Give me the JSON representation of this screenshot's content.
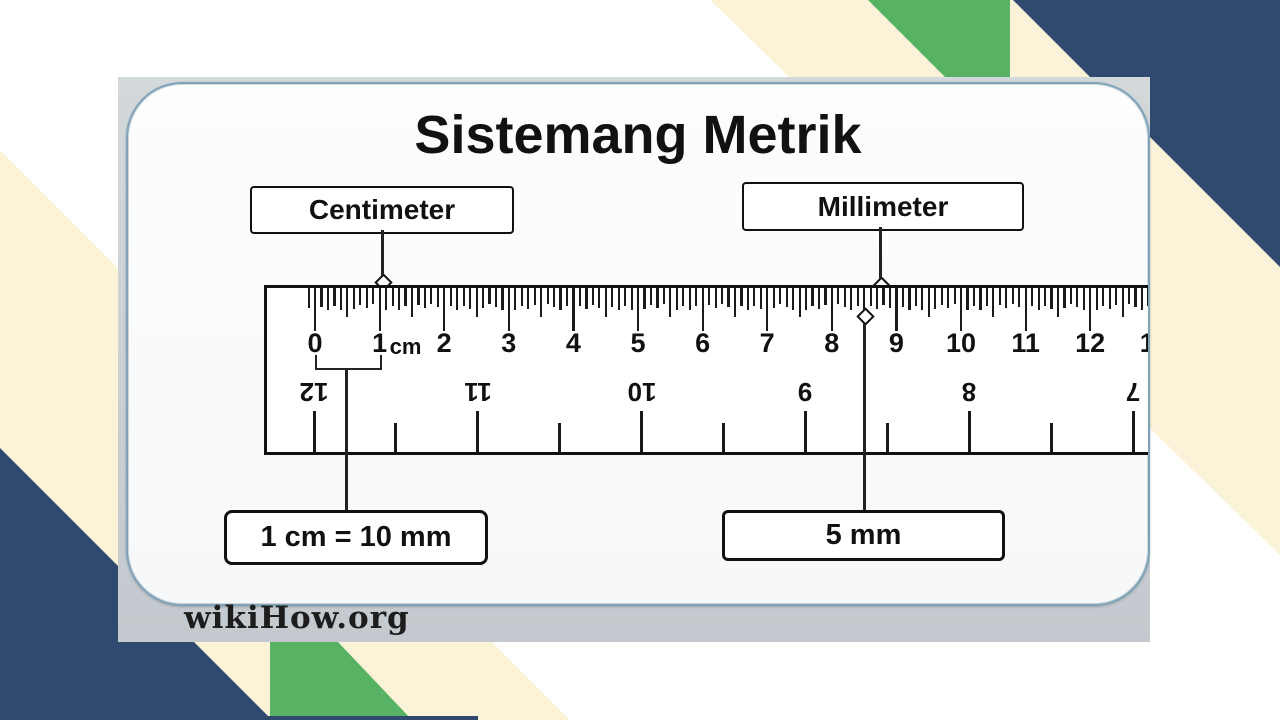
{
  "colors": {
    "navy": "#2f4a6e",
    "green": "#58b264",
    "cream": "#fbf3d8",
    "photo_gray": "#c7cdd2",
    "card_border": "#7fa3b8"
  },
  "photo": {
    "watermark": "wikiHow.org"
  },
  "diagram": {
    "title": "Sistemang Metrik",
    "labels": {
      "centimeter": "Centimeter",
      "millimeter": "Millimeter",
      "cm_equation": "1 cm = 10 mm",
      "five_mm": "5 mm",
      "cm_unit": "cm"
    },
    "ruler": {
      "cm_numbers": [
        "0",
        "1",
        "2",
        "3",
        "4",
        "5",
        "6",
        "7",
        "8",
        "9",
        "10",
        "11",
        "12",
        "13"
      ],
      "inch_numbers": [
        "12",
        "11",
        "10",
        "9",
        "8",
        "7"
      ]
    }
  }
}
